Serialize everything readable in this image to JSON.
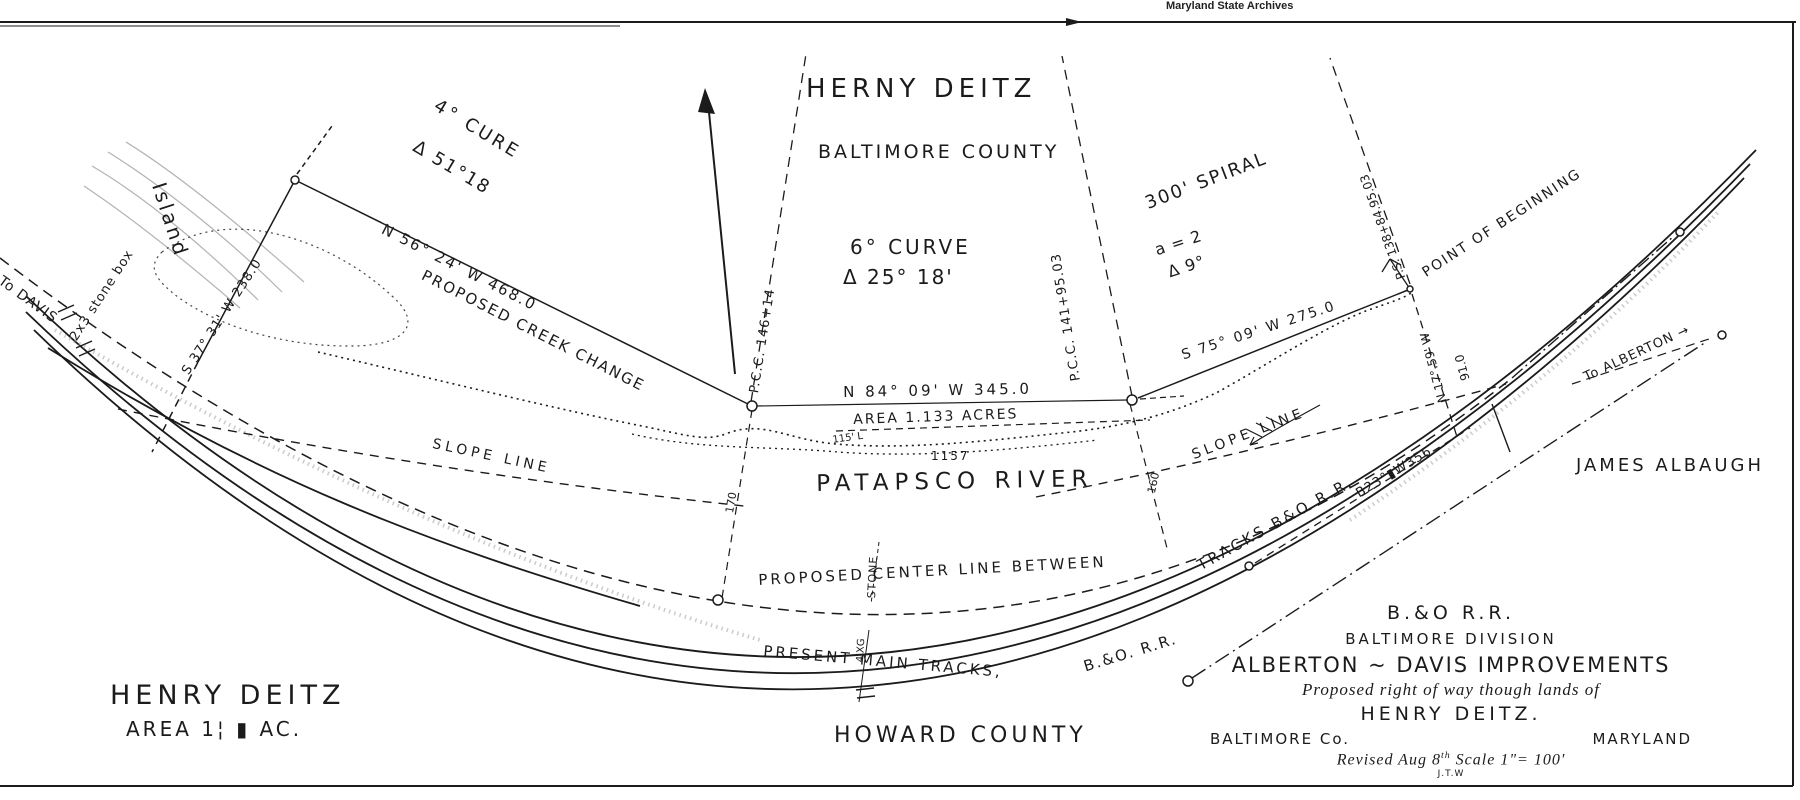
{
  "archive_header": "Maryland State Archives",
  "ink_color": "#1b1b1b",
  "paper_color": "#ffffff",
  "labels": {
    "herny_deitz": "HERNY DEITZ",
    "baltimore_county": "BALTIMORE COUNTY",
    "curve4": "4° CURE",
    "curve4_delta": "Δ 51°18",
    "island": "Island",
    "to_davis": "To DAVIS",
    "stone_box": "2x3 stone box",
    "s37": "S 37° 31' W 238.0",
    "n56": "N 56° 24' W  468.0",
    "creek": "PROPOSED CREEK CHANGE",
    "pcc146": "P.C.C. 146+14",
    "curve6": "6° CURVE",
    "curve6_delta": "Δ 25° 18'",
    "pcc141": "P.C.C. 141+95.03",
    "spiral": "300' SPIRAL",
    "spiral_a": "a = 2",
    "spiral_delta": "Δ  9°",
    "ps138": "P.S. 138+84.95.03",
    "pob": "POINT OF BEGINNING",
    "s75": "S 75° 09' W  275.0",
    "n17": "N 17°.59' W",
    "n17_dist": "91.0",
    "n84": "N 84° 09' W   345.0",
    "area_acres": "AREA 1.133 ACRES",
    "dim115": "115' L",
    "num1157": "1157",
    "patapsco": "PATAPSCO RIVER",
    "num160": "160",
    "num170": "170",
    "slope_left": "SLOPE LINE",
    "slope_right": "SLOPE LINE",
    "center_left": "PROPOSED CENTER LINE BETWEEN",
    "center_right": "TRACKS B&O R.R.",
    "b23": "B23°▮W356",
    "stone": "STONE",
    "xing": "4'XG",
    "present1": "PRESENT MAIN TRACKS,",
    "present2": "B.&O. R.R.",
    "to_alberton": "To ALBERTON →",
    "james_albaugh": "JAMES ALBAUGH",
    "henry_deitz": "HENRY DEITZ",
    "area_bl": "AREA 1¦ ▮ AC.",
    "howard_county": "HOWARD COUNTY"
  },
  "title_block": {
    "l1": "B.&O R.R.",
    "l2": "BALTIMORE DIVISION",
    "l3": "ALBERTON ~ DAVIS IMPROVEMENTS",
    "l4": "Proposed right of way though lands of",
    "l5": "HENRY DEITZ.",
    "l6a": "BALTIMORE Co.",
    "l6b": "MARYLAND",
    "l7a": "Revised Aug 8",
    "l7sup": "th",
    "l7b": " Scale 1\"= 100'",
    "l8": "J.T.W"
  }
}
